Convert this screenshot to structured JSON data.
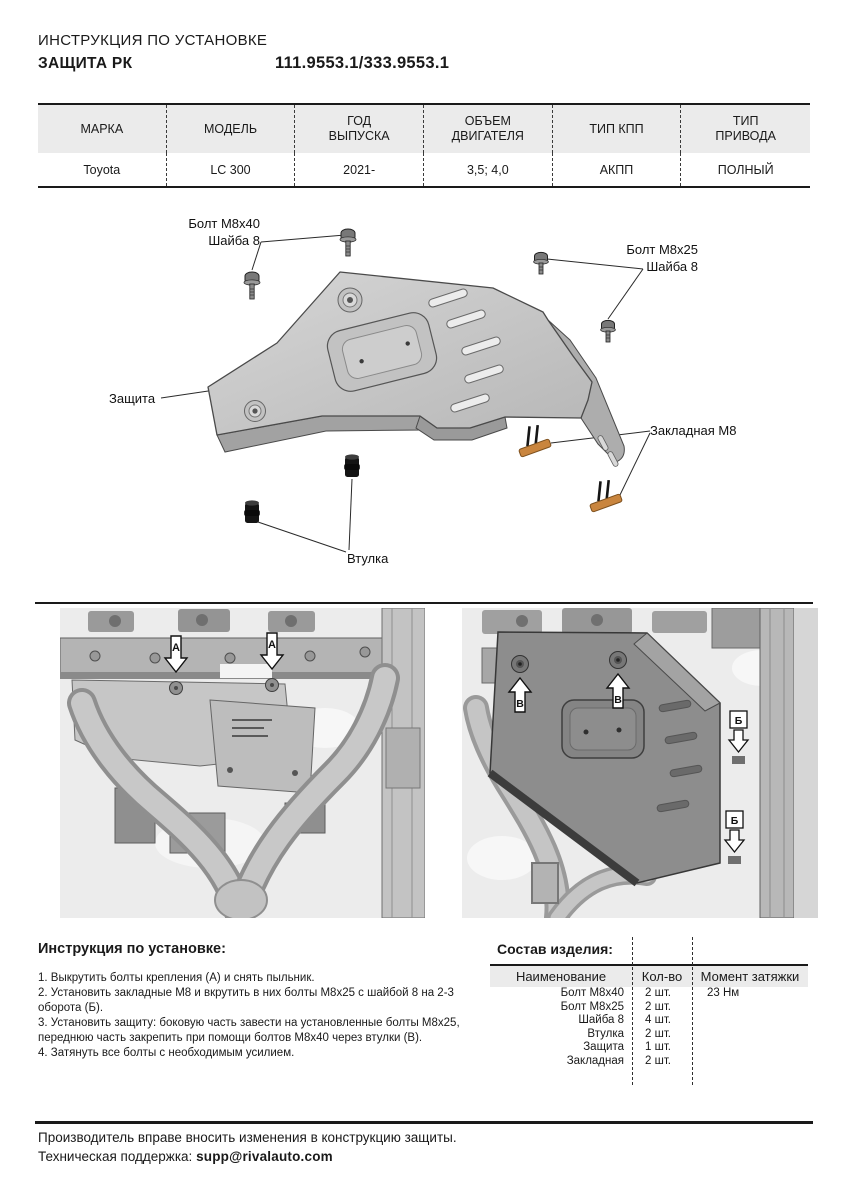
{
  "header": {
    "line1": "ИНСТРУКЦИЯ ПО УСТАНОВКЕ",
    "line2": "ЗАЩИТА РК",
    "part_numbers": "111.9553.1/333.9553.1"
  },
  "spec_table": {
    "headers": [
      "МАРКА",
      "МОДЕЛЬ",
      "ГОД\nВЫПУСКА",
      "ОБЪЕМ\nДВИГАТЕЛЯ",
      "ТИП КПП",
      "ТИП\nПРИВОДА"
    ],
    "row": [
      "Toyota",
      "LC 300",
      "2021-",
      "3,5; 4,0",
      "АКПП",
      "ПОЛНЫЙ"
    ]
  },
  "diagram": {
    "labels": {
      "bolt_m8x40": "Болт M8x40",
      "washer_left": "Шайба 8",
      "bolt_m8x25": "Болт M8x25",
      "washer_right": "Шайба 8",
      "shield": "Защита",
      "embedded_nut": "Закладная M8",
      "bushing": "Втулка"
    }
  },
  "photos": {
    "marker_a": "А",
    "marker_b": "Б",
    "marker_v": "В"
  },
  "install": {
    "title": "Инструкция по установке:",
    "steps": [
      "1. Выкрутить болты крепления (А) и снять пыльник.",
      "2. Установить закладные М8 и вкрутить в них болты М8х25 с шайбой 8 на 2-3 оборота (Б).",
      "3. Установить защиту: боковую часть завести на установленные болты М8х25, переднюю часть закрепить при помощи болтов М8х40 через втулки (В).",
      "4. Затянуть все болты с необходимым усилием."
    ]
  },
  "composition": {
    "title": "Состав изделия:",
    "headers": [
      "Наименование",
      "Кол-во",
      "Момент затяжки"
    ],
    "rows": [
      {
        "name": "Болт M8x40",
        "qty": "2 шт.",
        "torque": "23 Нм"
      },
      {
        "name": "Болт M8x25",
        "qty": "2 шт.",
        "torque": ""
      },
      {
        "name": "Шайба 8",
        "qty": "4 шт.",
        "torque": ""
      },
      {
        "name": "Втулка",
        "qty": "2 шт.",
        "torque": ""
      },
      {
        "name": "Защита",
        "qty": "1 шт.",
        "torque": ""
      },
      {
        "name": "Закладная",
        "qty": "2 шт.",
        "torque": ""
      }
    ]
  },
  "footer": {
    "line1": "Производитель вправе вносить изменения в конструкцию защиты.",
    "support_label": "Техническая поддержка:",
    "email": "supp@rivalauto.com"
  },
  "colors": {
    "hardware_orange": "#c9853e",
    "table_header_bg": "#ebebeb",
    "text": "#1a1a1a"
  }
}
